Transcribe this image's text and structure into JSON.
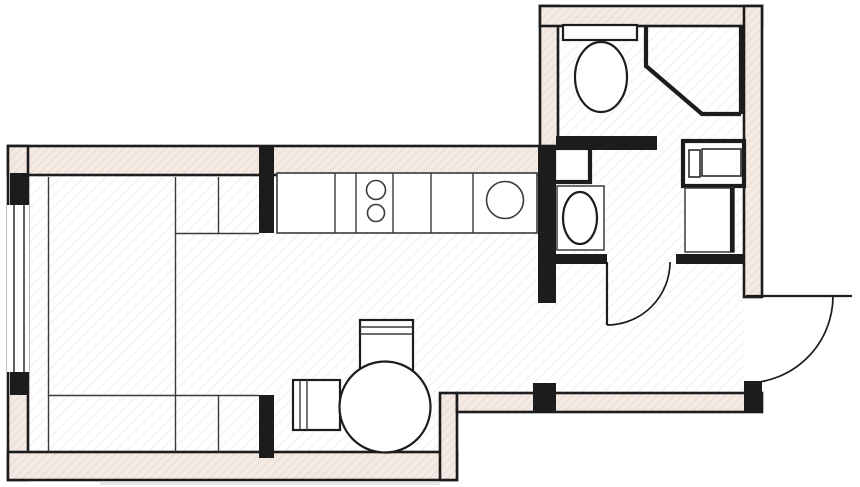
{
  "meta": {
    "type": "architectural-floor-plan",
    "description": "Black and white studio apartment floor plan with pink-hatched walls, kitchen counter, round dining table, bed unit, bathroom with corner shower and toilet, laundry-vanity room, entry hall and outward-swinging entrance door",
    "canvas_width": 860,
    "canvas_height": 487,
    "visible_text": "none"
  },
  "palette": {
    "line": "#1c1c1c",
    "wall_fill": "#f4eae4",
    "wall_hatch_line": "#e5d4ca",
    "floor_fill": "#ffffff",
    "floor_hatch_line": "#f2e8e3",
    "furniture_line": "#3a3a3a",
    "shadow": "#cfc9c6"
  },
  "rooms": [
    {
      "name": "living-sleeping-area",
      "position": "left",
      "fixtures": [
        "bed-wardrobe-unit",
        "living-room-window"
      ]
    },
    {
      "name": "kitchen",
      "position": "top-middle",
      "fixtures": [
        "kitchen-counter",
        "two-burner-cooktop",
        "kitchen-sink"
      ]
    },
    {
      "name": "dining-area",
      "position": "bottom-middle",
      "fixtures": [
        "round-dining-table",
        "dining-chair-top",
        "dining-chair-left"
      ]
    },
    {
      "name": "shower-wc-room",
      "position": "top-right-upper",
      "fixtures": [
        "toilet-with-tank",
        "corner-shower"
      ]
    },
    {
      "name": "laundry-vanity-room",
      "position": "top-right-lower",
      "fixtures": [
        "vanity-counter",
        "vanity-sink",
        "washing-machine",
        "cabinet",
        "service-niche"
      ]
    },
    {
      "name": "entry-hall",
      "position": "right-bottom",
      "fixtures": []
    }
  ],
  "doors": [
    {
      "name": "entrance-door",
      "location": "right exterior wall of entry hall",
      "swing": "outward quarter-arc"
    },
    {
      "name": "bathroom-door",
      "location": "between laundry-vanity room and entry hall",
      "swing": "into hall quarter-arc"
    },
    {
      "name": "kitchen-hall-passage",
      "location": "between kitchen area and entry hall",
      "type": "open-passage"
    },
    {
      "name": "shower-room-passage",
      "location": "between shower-wc room and laundry-vanity room",
      "type": "open-passage"
    }
  ],
  "windows": [
    {
      "name": "living-room-window",
      "location": "left exterior wall",
      "glazing_lines": 2
    }
  ],
  "geometry": {
    "shapes": [
      {
        "t": "rect",
        "name": "floor-living-kitchen",
        "cls": "floor",
        "x": 28,
        "y": 175,
        "w": 509,
        "h": 218
      },
      {
        "t": "rect",
        "name": "floor-dining",
        "cls": "floor",
        "x": 28,
        "y": 393,
        "w": 429,
        "h": 59
      },
      {
        "t": "rect",
        "name": "floor-bathroom",
        "cls": "floor",
        "x": 559,
        "y": 26,
        "w": 185,
        "h": 228
      },
      {
        "t": "rect",
        "name": "floor-entry-hall",
        "cls": "floor",
        "x": 556,
        "y": 264,
        "w": 188,
        "h": 129
      },
      {
        "t": "rect",
        "name": "floor-passage",
        "cls": "floor",
        "x": 537,
        "y": 303,
        "w": 19,
        "h": 80
      },
      {
        "t": "rect",
        "name": "floor-bath-doorway",
        "cls": "floor",
        "x": 607,
        "y": 252,
        "w": 69,
        "h": 12
      },
      {
        "t": "rect",
        "name": "wall-top",
        "cls": "wall-hatched",
        "x": 8,
        "y": 146,
        "w": 548,
        "h": 29
      },
      {
        "t": "rect",
        "name": "wall-left",
        "cls": "wall-hatched",
        "x": 8,
        "y": 146,
        "w": 20,
        "h": 334
      },
      {
        "t": "rect",
        "name": "wall-bottom-left",
        "cls": "wall-hatched",
        "x": 8,
        "y": 452,
        "w": 449,
        "h": 28
      },
      {
        "t": "rect",
        "name": "wall-step",
        "cls": "wall-hatched",
        "x": 440,
        "y": 393,
        "w": 17,
        "h": 87
      },
      {
        "t": "rect",
        "name": "wall-hall-bottom",
        "cls": "wall-hatched",
        "x": 457,
        "y": 393,
        "w": 305,
        "h": 19
      },
      {
        "t": "rect",
        "name": "wall-bathroom-left",
        "cls": "wall-hatched",
        "x": 540,
        "y": 6,
        "w": 18,
        "h": 140
      },
      {
        "t": "rect",
        "name": "wall-bathroom-top",
        "cls": "wall-hatched",
        "x": 540,
        "y": 6,
        "w": 222,
        "h": 20
      },
      {
        "t": "rect",
        "name": "wall-bathroom-right",
        "cls": "wall-hatched",
        "x": 744,
        "y": 6,
        "w": 18,
        "h": 291
      },
      {
        "t": "rect",
        "name": "window-opening",
        "cls": "white",
        "x": 7,
        "y": 205,
        "w": 22,
        "h": 167
      },
      {
        "t": "line",
        "name": "window-glazing-outer",
        "cls": "thin",
        "x1": 14,
        "y1": 205,
        "x2": 14,
        "y2": 372
      },
      {
        "t": "line",
        "name": "window-glazing-inner",
        "cls": "thin",
        "x1": 24,
        "y1": 205,
        "x2": 24,
        "y2": 372
      },
      {
        "t": "rect",
        "name": "window-pier-top",
        "cls": "wall-solid",
        "x": 10,
        "y": 173,
        "w": 18,
        "h": 32
      },
      {
        "t": "rect",
        "name": "window-pier-bottom",
        "cls": "wall-solid",
        "x": 10,
        "y": 372,
        "w": 18,
        "h": 23
      },
      {
        "t": "rect",
        "name": "partition-kitchen-hall",
        "cls": "wall-solid",
        "x": 538,
        "y": 146,
        "w": 18,
        "h": 157
      },
      {
        "t": "rect",
        "name": "partition-stub-upper",
        "cls": "wall-solid",
        "x": 259,
        "y": 146,
        "w": 15,
        "h": 87
      },
      {
        "t": "rect",
        "name": "partition-stub-lower",
        "cls": "wall-solid",
        "x": 259,
        "y": 395,
        "w": 15,
        "h": 63
      },
      {
        "t": "rect",
        "name": "partition-hall-stub",
        "cls": "wall-solid",
        "x": 533,
        "y": 383,
        "w": 23,
        "h": 29
      },
      {
        "t": "rect",
        "name": "partition-bathroom-middle",
        "cls": "wall-solid",
        "x": 556,
        "y": 136,
        "w": 101,
        "h": 14
      },
      {
        "t": "rect",
        "name": "partition-bath-door-left",
        "cls": "wall-solid",
        "x": 556,
        "y": 254,
        "w": 51,
        "h": 10
      },
      {
        "t": "rect",
        "name": "partition-bath-door-right",
        "cls": "wall-solid",
        "x": 676,
        "y": 254,
        "w": 68,
        "h": 10
      },
      {
        "t": "rect",
        "name": "wall-entry-corner",
        "cls": "wall-solid",
        "x": 744,
        "y": 381,
        "w": 18,
        "h": 31
      },
      {
        "t": "line",
        "name": "bed-unit-line-left",
        "cls": "furn",
        "x1": 48.5,
        "y1": 177,
        "x2": 48.5,
        "y2": 452
      },
      {
        "t": "line",
        "name": "bed-unit-line-middle",
        "cls": "furn",
        "x1": 175.5,
        "y1": 177,
        "x2": 175.5,
        "y2": 452
      },
      {
        "t": "line",
        "name": "bed-unit-line-right-upper",
        "cls": "furn",
        "x1": 218.5,
        "y1": 177,
        "x2": 218.5,
        "y2": 233
      },
      {
        "t": "line",
        "name": "bed-unit-line-right-lower",
        "cls": "furn",
        "x1": 218.5,
        "y1": 395,
        "x2": 218.5,
        "y2": 452
      },
      {
        "t": "line",
        "name": "bed-unit-shelf-top",
        "cls": "furn",
        "x1": 175,
        "y1": 233.5,
        "x2": 259,
        "y2": 233.5
      },
      {
        "t": "line",
        "name": "bed-unit-shelf-bottom",
        "cls": "furn",
        "x1": 48,
        "y1": 395.5,
        "x2": 259,
        "y2": 395.5
      },
      {
        "t": "rect",
        "name": "kitchen-counter",
        "cls": "fixture-thin",
        "x": 277,
        "y": 173,
        "w": 260,
        "h": 60
      },
      {
        "t": "line",
        "name": "counter-divider-1",
        "cls": "furn",
        "x1": 335,
        "y1": 173,
        "x2": 335,
        "y2": 233
      },
      {
        "t": "line",
        "name": "counter-divider-2",
        "cls": "furn",
        "x1": 356,
        "y1": 173,
        "x2": 356,
        "y2": 233
      },
      {
        "t": "line",
        "name": "counter-divider-3",
        "cls": "furn",
        "x1": 393,
        "y1": 173,
        "x2": 393,
        "y2": 233
      },
      {
        "t": "line",
        "name": "counter-divider-4",
        "cls": "furn",
        "x1": 431,
        "y1": 173,
        "x2": 431,
        "y2": 233
      },
      {
        "t": "line",
        "name": "counter-divider-5",
        "cls": "furn",
        "x1": 473,
        "y1": 173,
        "x2": 473,
        "y2": 233
      },
      {
        "t": "circle",
        "name": "cooktop-burner-top",
        "cls": "fixture-thin",
        "cx": 376,
        "cy": 190,
        "r": 9.5
      },
      {
        "t": "circle",
        "name": "cooktop-burner-bottom",
        "cls": "fixture-thin",
        "cx": 376,
        "cy": 213,
        "r": 8.5
      },
      {
        "t": "circle",
        "name": "kitchen-sink",
        "cls": "fixture-thin",
        "cx": 505,
        "cy": 200,
        "r": 18.5
      },
      {
        "t": "rect",
        "name": "dining-chair-top",
        "cls": "fixture",
        "x": 360,
        "y": 320,
        "w": 53,
        "h": 52
      },
      {
        "t": "line",
        "name": "chair-top-back-line-1",
        "cls": "furn",
        "x1": 360,
        "y1": 327,
        "x2": 413,
        "y2": 327
      },
      {
        "t": "line",
        "name": "chair-top-back-line-2",
        "cls": "furn",
        "x1": 360,
        "y1": 334,
        "x2": 413,
        "y2": 334
      },
      {
        "t": "rect",
        "name": "dining-chair-left",
        "cls": "fixture",
        "x": 293,
        "y": 380,
        "w": 47,
        "h": 50
      },
      {
        "t": "line",
        "name": "chair-left-back-line-1",
        "cls": "furn",
        "x1": 300,
        "y1": 380,
        "x2": 300,
        "y2": 430
      },
      {
        "t": "line",
        "name": "chair-left-back-line-2",
        "cls": "furn",
        "x1": 307,
        "y1": 380,
        "x2": 307,
        "y2": 430
      },
      {
        "t": "circle",
        "name": "round-dining-table",
        "cls": "fixture",
        "cx": 385,
        "cy": 407,
        "r": 45.5
      },
      {
        "t": "rect",
        "name": "toilet-tank",
        "cls": "fixture",
        "x": 563,
        "y": 25,
        "w": 74,
        "h": 15
      },
      {
        "t": "ellipse",
        "name": "toilet-bowl",
        "cls": "fixture",
        "cx": 601,
        "cy": 77,
        "rx": 26,
        "ry": 35
      },
      {
        "t": "path",
        "name": "corner-shower-outline",
        "cls": "thick-line",
        "d": "M646,26 L646,66 L702,114 L741,114"
      },
      {
        "t": "line",
        "name": "corner-shower-right-edge",
        "cls": "thick-line",
        "x1": 741,
        "y1": 26,
        "x2": 741,
        "y2": 114
      },
      {
        "t": "rect",
        "name": "service-niche",
        "cls": "fixture-heavy",
        "x": 554,
        "y": 148,
        "w": 36,
        "h": 34
      },
      {
        "t": "rect",
        "name": "washing-machine",
        "cls": "fixture-heavy",
        "x": 683,
        "y": 141,
        "w": 61,
        "h": 45
      },
      {
        "t": "rect",
        "name": "washing-machine-detail-left",
        "cls": "outline-thin",
        "x": 689,
        "y": 150,
        "w": 11,
        "h": 27
      },
      {
        "t": "rect",
        "name": "washing-machine-detail-right",
        "cls": "outline-thin",
        "x": 702,
        "y": 149,
        "w": 39,
        "h": 27
      },
      {
        "t": "rect",
        "name": "bath-cabinet",
        "cls": "fixture-thinline",
        "x": 685,
        "y": 188,
        "w": 49,
        "h": 64
      },
      {
        "t": "line",
        "name": "bath-cabinet-front-edge",
        "cls": "thick-line",
        "x1": 732,
        "y1": 188,
        "x2": 732,
        "y2": 252
      },
      {
        "t": "rect",
        "name": "vanity-counter",
        "cls": "fixture-thinline",
        "x": 557,
        "y": 186,
        "w": 47,
        "h": 64
      },
      {
        "t": "ellipse",
        "name": "vanity-sink",
        "cls": "fixture",
        "cx": 580,
        "cy": 218,
        "rx": 17,
        "ry": 26
      },
      {
        "t": "line",
        "name": "bathroom-door-leaf",
        "cls": "door-line",
        "x1": 607,
        "y1": 262,
        "x2": 607,
        "y2": 325
      },
      {
        "t": "path",
        "name": "bathroom-door-swing-arc",
        "cls": "arc",
        "d": "M670,262 A63,63 0 0 1 607,325"
      },
      {
        "t": "line",
        "name": "entrance-door-leaf",
        "cls": "door-line",
        "x1": 746,
        "y1": 296,
        "x2": 852,
        "y2": 296
      },
      {
        "t": "path",
        "name": "entrance-door-swing-arc",
        "cls": "arc",
        "d": "M833,296 A87,87 0 0 1 746,383"
      },
      {
        "t": "rect",
        "name": "bottom-shadow",
        "cls": "shadow",
        "x": 100,
        "y": 481,
        "w": 340,
        "h": 4
      }
    ]
  }
}
